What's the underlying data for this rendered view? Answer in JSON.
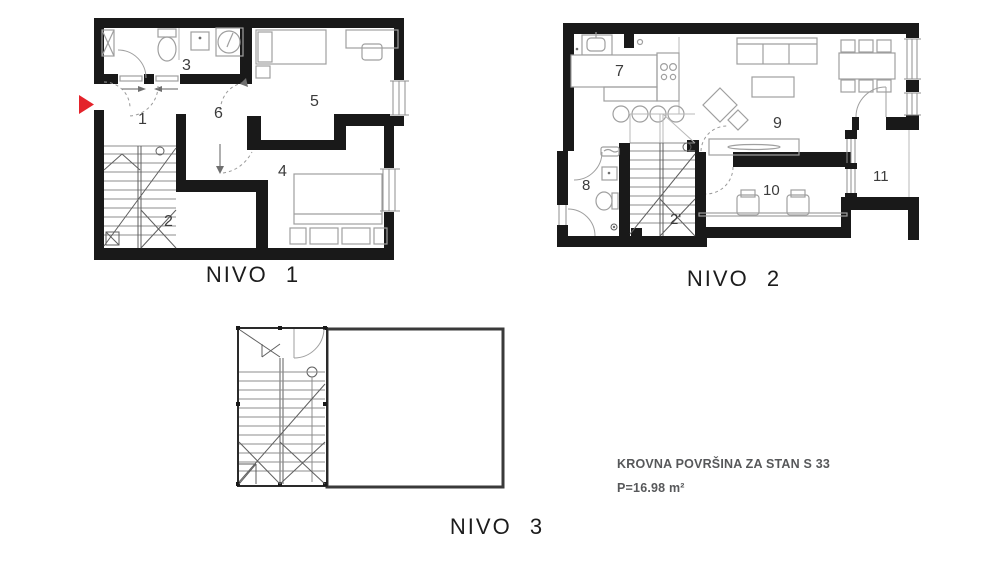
{
  "colors": {
    "wall": "#191919",
    "furniture": "#9f9f9f",
    "accent_red": "#e4232b",
    "annotation_text": "#57585a",
    "label_text": "#1c1c1c"
  },
  "plans": {
    "nivo1": {
      "label": "NIVO 1",
      "rooms": {
        "r1": "1",
        "r2": "2",
        "r3": "3",
        "r4": "4",
        "r5": "5",
        "r6": "6"
      }
    },
    "nivo2": {
      "label": "NIVO 2",
      "rooms": {
        "r7": "7",
        "r8": "8",
        "r9": "9",
        "r10": "10",
        "r2p": "2'",
        "r11": "11"
      }
    },
    "nivo3": {
      "label": "NIVO 3"
    }
  },
  "annotation": {
    "line1": "KROVNA POVRŠINA ZA STAN S 33",
    "line2": "P=16.98 m²"
  }
}
